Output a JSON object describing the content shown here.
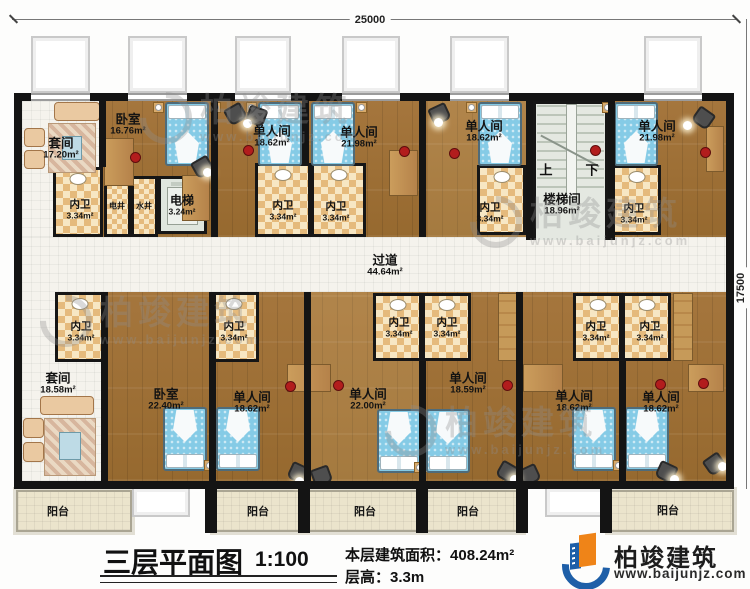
{
  "dimensions": {
    "top": "25000",
    "right": "17500"
  },
  "corridor": {
    "name": "过道",
    "area": "44.64m²"
  },
  "stairs": {
    "up": "上",
    "down": "下"
  },
  "shafts": {
    "electric": "电井",
    "water": "水井"
  },
  "elevator": {
    "name": "电梯",
    "area": "3.24m²"
  },
  "rooms_top": [
    {
      "name": "套间",
      "area": "17.20m²"
    },
    {
      "name": "卧室",
      "area": "16.76m²"
    },
    {
      "name": "单人间",
      "area": "18.62m²"
    },
    {
      "name": "单人间",
      "area": "21.98m²"
    },
    {
      "name": "单人间",
      "area": "18.62m²"
    },
    {
      "name": "楼梯间",
      "area": "18.96m²"
    },
    {
      "name": "单人间",
      "area": "21.98m²"
    }
  ],
  "baths_top": [
    {
      "name": "内卫",
      "area": "3.34m²"
    },
    {
      "name": "内卫",
      "area": "3.34m²"
    },
    {
      "name": "内卫",
      "area": "3.34m²"
    },
    {
      "name": "内卫",
      "area": "3.34m²"
    },
    {
      "name": "内卫",
      "area": "3.34m²"
    }
  ],
  "baths_bottom": [
    {
      "name": "内卫",
      "area": "3.34m²"
    },
    {
      "name": "内卫",
      "area": "3.34m²"
    },
    {
      "name": "内卫",
      "area": "3.34m²"
    },
    {
      "name": "内卫",
      "area": "3.34m²"
    },
    {
      "name": "内卫",
      "area": "3.34m²"
    },
    {
      "name": "内卫",
      "area": "3.34m²"
    }
  ],
  "rooms_bottom": [
    {
      "name": "套间",
      "area": "18.58m²"
    },
    {
      "name": "卧室",
      "area": "22.40m²"
    },
    {
      "name": "单人间",
      "area": "18.62m²"
    },
    {
      "name": "单人间",
      "area": "22.00m²"
    },
    {
      "name": "单人间",
      "area": "18.59m²"
    },
    {
      "name": "单人间",
      "area": "18.62m²"
    },
    {
      "name": "单人间",
      "area": "18.62m²"
    }
  ],
  "balconies": [
    "阳台",
    "阳台",
    "阳台",
    "阳台",
    "阳台"
  ],
  "footer": {
    "title": "三层平面图",
    "scale": "1:100",
    "area_label": "本层建筑面积：",
    "area_value": "408.24m²",
    "height_label": "层高：",
    "height_value": "3.3m"
  },
  "brand": {
    "name": "柏竣建筑",
    "site": "www.baijunjz.com"
  },
  "watermark": {
    "name": "柏竣建筑",
    "site": "www.baijunjz.com"
  },
  "colors": {
    "wall": "#141414",
    "wood": "#a5763d",
    "bath_tile": "#e5ba7c",
    "brand_blue": "#1e5fa8",
    "brand_orange": "#ef8418"
  }
}
